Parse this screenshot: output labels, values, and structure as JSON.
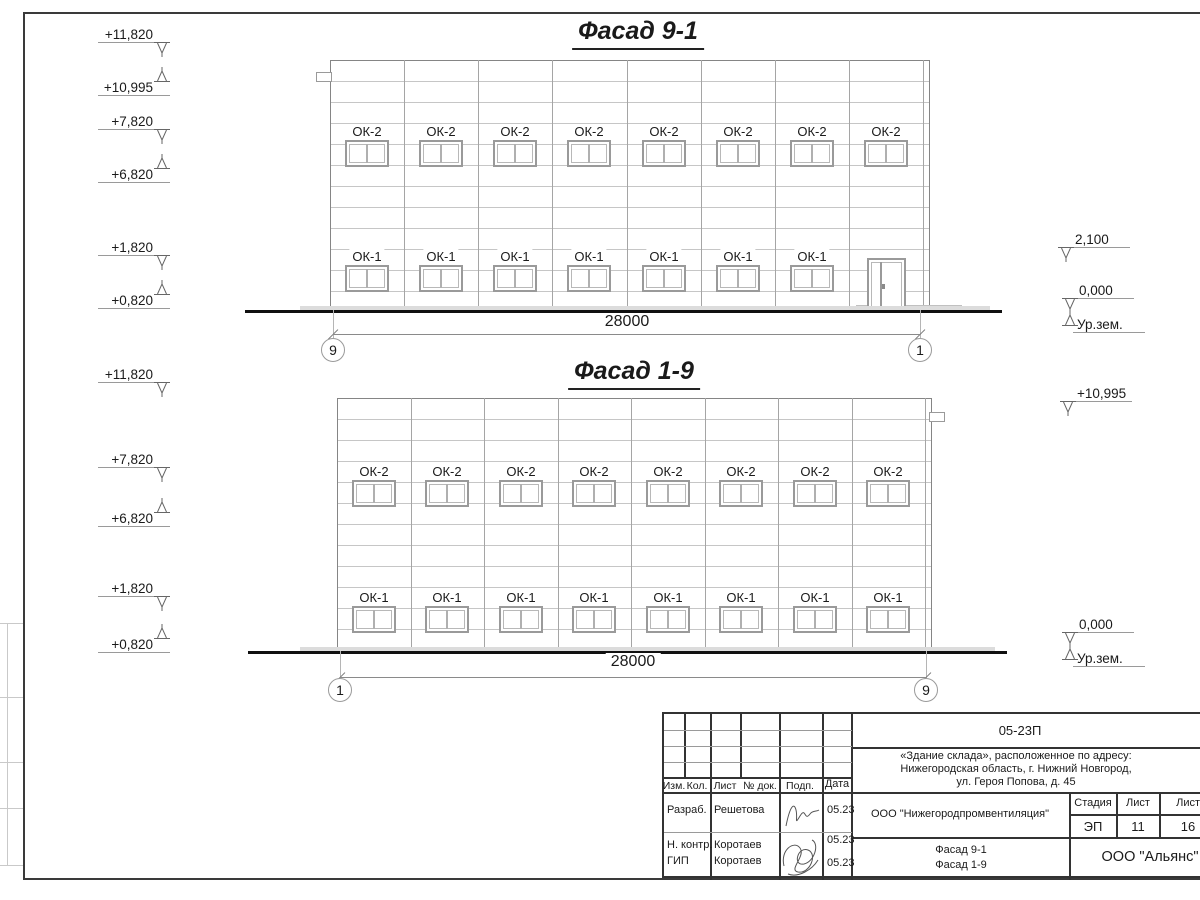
{
  "facades": [
    {
      "id": "9-1",
      "title": "Фасад 9-1",
      "dimension": "28000",
      "axis_left": "9",
      "axis_right": "1",
      "rows": [
        {
          "label": "ОК-2",
          "count": 8
        },
        {
          "label": "ОК-1",
          "count": 7
        }
      ],
      "has_door": true,
      "marks_left": [
        {
          "text": "+11,820",
          "arrow": "down"
        },
        {
          "text": "+10,995",
          "arrow": "up"
        },
        {
          "text": "+7,820",
          "arrow": "down"
        },
        {
          "text": "+6,820",
          "arrow": "up"
        },
        {
          "text": "+1,820",
          "arrow": "down"
        },
        {
          "text": "+0,820",
          "arrow": "up"
        }
      ],
      "marks_right": [
        {
          "text": "2,100",
          "arrow": "down"
        },
        {
          "text": "0,000",
          "arrow": "downup"
        },
        {
          "text": "Ур.зем.",
          "arrow": "none"
        }
      ]
    },
    {
      "id": "1-9",
      "title": "Фасад 1-9",
      "dimension": "28000",
      "axis_left": "1",
      "axis_right": "9",
      "rows": [
        {
          "label": "ОК-2",
          "count": 8
        },
        {
          "label": "ОК-1",
          "count": 8
        }
      ],
      "has_door": false,
      "marks_left": [
        {
          "text": "+11,820",
          "arrow": "down"
        },
        {
          "text": "+7,820",
          "arrow": "down"
        },
        {
          "text": "+6,820",
          "arrow": "up"
        },
        {
          "text": "+1,820",
          "arrow": "down"
        },
        {
          "text": "+0,820",
          "arrow": "up"
        }
      ],
      "marks_right": [
        {
          "text": "+10,995",
          "arrow": "down"
        },
        {
          "text": "0,000",
          "arrow": "downup"
        },
        {
          "text": "Ур.зем.",
          "arrow": "none"
        }
      ]
    }
  ],
  "titleblock": {
    "code": "05-23П",
    "address": [
      "«Здание склада», расположенное по адресу:",
      "Нижегородская область, г. Нижний Новгород,",
      "ул. Героя Попова, д. 45"
    ],
    "cols": [
      "Изм.",
      "Кол.",
      "Лист",
      "№ док.",
      "Подп.",
      "Дата"
    ],
    "rows": [
      {
        "role": "Разраб.",
        "name": "Решетова",
        "date": "05.23"
      },
      {
        "role": "Н. контр.",
        "name": "Коротаев",
        "date": "05.23"
      },
      {
        "role": "ГИП",
        "name": "Коротаев",
        "date": "05.23"
      }
    ],
    "org": "ООО \"Нижегородпромвентиляция\"",
    "stage_label": "Стадия",
    "sheet_label": "Лист",
    "sheets_label": "Листов",
    "stage": "ЭП",
    "sheet_no": "11",
    "sheets_total": "16",
    "drawing_titles": [
      "Фасад 9-1",
      "Фасад 1-9"
    ],
    "company": "ООО \"Альянс\""
  }
}
